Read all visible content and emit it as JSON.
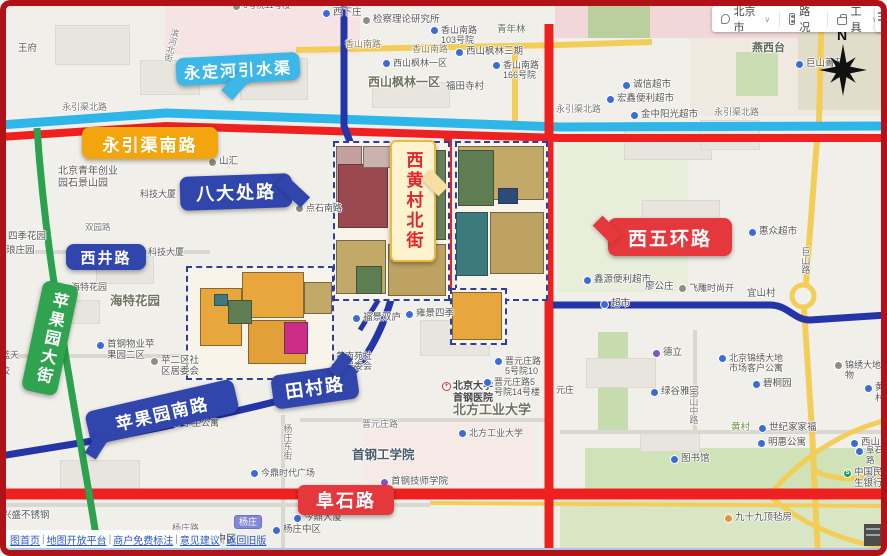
{
  "toolbar": {
    "city": "北京市",
    "traffic": "路况",
    "tools": "工具",
    "chevron": "∨"
  },
  "compass_label": "N",
  "callouts": {
    "yongdinghe": {
      "label": "永定河引水渠",
      "color": "#3db7e8",
      "text_color": "#ffffff"
    },
    "yongyinqu": {
      "label": "永引渠南路",
      "color": "#f2a50c",
      "text_color": "#ffffff"
    },
    "badachu": {
      "label": "八大处路",
      "color": "#3146ad",
      "text_color": "#ffffff"
    },
    "xijing": {
      "label": "西井路",
      "color": "#3146ad",
      "text_color": "#ffffff"
    },
    "pingguoyuan_dajie": {
      "label": "苹果园大街",
      "color": "#2fa350",
      "text_color": "#ffffff"
    },
    "pingguoyuan_nanlu": {
      "label": "苹果园南路",
      "color": "#3146ad",
      "text_color": "#ffffff"
    },
    "tiancun": {
      "label": "田村路",
      "color": "#3146ad",
      "text_color": "#ffffff"
    },
    "xihuangcun": {
      "label": "西黄村北街",
      "color": "#fdf4cf",
      "text_color": "#e2262b",
      "border_color": "#f0b840",
      "tail_color": "#f6dfa0"
    },
    "xiwuhuan": {
      "label": "西五环路",
      "color": "#e5383d",
      "text_color": "#ffffff"
    },
    "fushi": {
      "label": "阜石路",
      "color": "#e5383d",
      "text_color": "#ffffff"
    }
  },
  "road_colors": {
    "river": "#2eb6e8",
    "highlight_red": "#ee2020",
    "highlight_blue": "#2435a8",
    "highlight_green": "#2ca14e",
    "yellow": "#f2ce58",
    "minor": "#d9d7cf"
  },
  "footer": {
    "links": [
      "图首页",
      "地图开放平台",
      "商户免费标注",
      "意见建议",
      "返回旧版"
    ],
    "separator": "|"
  },
  "map_labels": [
    {
      "t": "6号院11号楼",
      "x": 232,
      "y": 1,
      "s": 8.5,
      "icon": "dot"
    },
    {
      "t": "王府",
      "x": 18,
      "y": 44
    },
    {
      "t": "滨河北街",
      "x": 166,
      "y": 28,
      "s": 8.5,
      "v": 1,
      "rot": 14,
      "c": "#777777"
    },
    {
      "t": "西下庄",
      "x": 322,
      "y": 8,
      "icon": "blue"
    },
    {
      "t": "检察理论研究所",
      "x": 362,
      "y": 15,
      "icon": "dot"
    },
    {
      "t": "香山南路",
      "x": 345,
      "y": 39,
      "s": 9,
      "c": "#8a7d55"
    },
    {
      "t": "香山南路",
      "x": 412,
      "y": 44,
      "s": 9,
      "c": "#8a7d55"
    },
    {
      "t": "香山南路\n103号院",
      "x": 430,
      "y": 25,
      "s": 9,
      "icon": "blue"
    },
    {
      "t": "青年林",
      "x": 497,
      "y": 25,
      "c": "#5c6e54"
    },
    {
      "t": "西山枫林三期",
      "x": 455,
      "y": 47,
      "icon": "blue"
    },
    {
      "t": "西山枫林一区",
      "x": 382,
      "y": 58,
      "s": 9,
      "icon": "blue"
    },
    {
      "t": "西山枫林一区",
      "x": 368,
      "y": 76,
      "s": 12,
      "b": 1,
      "c": "#6f735f"
    },
    {
      "t": "香山南路\n166号院",
      "x": 492,
      "y": 60,
      "s": 9,
      "icon": "blue"
    },
    {
      "t": "福田寺村",
      "x": 446,
      "y": 82
    },
    {
      "t": "燕西台",
      "x": 752,
      "y": 42,
      "s": 11,
      "b": 1,
      "c": "#5f6658"
    },
    {
      "t": "巨山菁苑",
      "x": 795,
      "y": 59,
      "icon": "blue"
    },
    {
      "t": "山路",
      "x": 818,
      "y": 4,
      "s": 9,
      "v": 1,
      "c": "#8a7d55"
    },
    {
      "t": "诚信超市",
      "x": 622,
      "y": 80,
      "icon": "blue"
    },
    {
      "t": "宏鑫便利超市",
      "x": 606,
      "y": 94,
      "icon": "blue"
    },
    {
      "t": "金中阳光超市",
      "x": 630,
      "y": 110,
      "icon": "blue"
    },
    {
      "t": "永引渠北路",
      "x": 62,
      "y": 102,
      "s": 9,
      "c": "#777777"
    },
    {
      "t": "永引渠北路",
      "x": 556,
      "y": 104,
      "s": 9,
      "c": "#777777"
    },
    {
      "t": "永引渠北路",
      "x": 714,
      "y": 107,
      "s": 9,
      "c": "#777777"
    },
    {
      "t": "北京青年创业\n园石景山园",
      "x": 58,
      "y": 166,
      "s": 10,
      "c": "#555555"
    },
    {
      "t": "山汇",
      "x": 208,
      "y": 157,
      "icon": "dot"
    },
    {
      "t": "科技大厦",
      "x": 140,
      "y": 189,
      "s": 9
    },
    {
      "t": "点石南路",
      "x": 295,
      "y": 203,
      "s": 9,
      "icon": "dot"
    },
    {
      "t": "四季花园",
      "x": 8,
      "y": 232
    },
    {
      "t": "琅庄园",
      "x": 6,
      "y": 246
    },
    {
      "t": "双园路",
      "x": 85,
      "y": 223,
      "s": 8.5,
      "c": "#777777"
    },
    {
      "t": "科技大厦",
      "x": 148,
      "y": 247,
      "s": 9
    },
    {
      "t": "海特花园",
      "x": 60,
      "y": 282,
      "s": 9,
      "icon": "blue"
    },
    {
      "t": "海特花园",
      "x": 110,
      "y": 294,
      "s": 12.5,
      "b": 1,
      "c": "#6f735f"
    },
    {
      "t": "蓝天",
      "x": 1,
      "y": 350,
      "s": 9
    },
    {
      "t": "校",
      "x": 1,
      "y": 366,
      "s": 9
    },
    {
      "t": "首钢物业苹\n果园二区",
      "x": 96,
      "y": 340,
      "icon": "blue"
    },
    {
      "t": "苹二区社\n区居委会",
      "x": 150,
      "y": 356,
      "icon": "dot"
    },
    {
      "t": "学生公寓",
      "x": 172,
      "y": 418,
      "s": 9,
      "icon": "blue"
    },
    {
      "t": "福景双庐",
      "x": 352,
      "y": 313,
      "icon": "blue"
    },
    {
      "t": "雍景四季",
      "x": 405,
      "y": 309,
      "icon": "blue"
    },
    {
      "t": "黄南苑社\n区居委会",
      "x": 336,
      "y": 351,
      "s": 9
    },
    {
      "t": "北京大学\n首钢医院",
      "x": 442,
      "y": 381,
      "s": 10,
      "b": 1,
      "c": "#444444",
      "icon": "hospital"
    },
    {
      "t": "晋元庄路\n5号院10",
      "x": 494,
      "y": 356,
      "s": 9,
      "icon": "blue"
    },
    {
      "t": "晋元庄路5\n号院14号楼",
      "x": 483,
      "y": 377,
      "s": 9,
      "icon": "blue"
    },
    {
      "t": "元庄",
      "x": 556,
      "y": 385,
      "s": 9
    },
    {
      "t": "晋元庄路",
      "x": 362,
      "y": 419,
      "s": 9,
      "c": "#777777"
    },
    {
      "t": "北方工业大学",
      "x": 453,
      "y": 403,
      "s": 13,
      "b": 1,
      "c": "#6f735f"
    },
    {
      "t": "北方工业大学",
      "x": 458,
      "y": 428,
      "s": 9,
      "icon": "blue"
    },
    {
      "t": "首钢工学院",
      "x": 352,
      "y": 448,
      "s": 12.5,
      "b": 1,
      "c": "#4d5c6a"
    },
    {
      "t": "首钢技师学院",
      "x": 380,
      "y": 477,
      "icon": "purple"
    },
    {
      "t": "图书馆",
      "x": 670,
      "y": 454,
      "icon": "blue"
    },
    {
      "t": "杨庄东街",
      "x": 282,
      "y": 424,
      "s": 9,
      "v": 1,
      "c": "#777777"
    },
    {
      "t": "今鼎时代广场",
      "x": 250,
      "y": 468,
      "s": 9,
      "icon": "blue"
    },
    {
      "t": "今鼎大厦",
      "x": 293,
      "y": 513,
      "icon": "blue"
    },
    {
      "t": "杨庄中区",
      "x": 272,
      "y": 525,
      "icon": "blue"
    },
    {
      "t": "兴盛不锈钢",
      "x": 2,
      "y": 511
    },
    {
      "t": "杨庄路",
      "x": 172,
      "y": 523,
      "s": 9,
      "c": "#777777"
    },
    {
      "t": "中区",
      "x": 216,
      "y": 534,
      "s": 10,
      "c": "#444444"
    },
    {
      "t": "杨庄",
      "x": 234,
      "y": 515,
      "badge": 1
    },
    {
      "t": "德立",
      "x": 652,
      "y": 348,
      "icon": "purple"
    },
    {
      "t": "北京锦绣大地\n市场客户公寓",
      "x": 718,
      "y": 353,
      "s": 9,
      "icon": "blue"
    },
    {
      "t": "碧桐园",
      "x": 752,
      "y": 379,
      "icon": "blue"
    },
    {
      "t": "绿谷雅园",
      "x": 650,
      "y": 387,
      "icon": "blue"
    },
    {
      "t": "宝山中路",
      "x": 688,
      "y": 388,
      "s": 9,
      "v": 1,
      "c": "#777777"
    },
    {
      "t": "黄村",
      "x": 731,
      "y": 423,
      "c": "#6d8f3f"
    },
    {
      "t": "世纪家家福",
      "x": 758,
      "y": 423,
      "icon": "blue"
    },
    {
      "t": "明惠公寓",
      "x": 757,
      "y": 438,
      "icon": "blue"
    },
    {
      "t": "惠众超市",
      "x": 748,
      "y": 227,
      "icon": "blue"
    },
    {
      "t": "鑫源便利超市",
      "x": 583,
      "y": 275,
      "icon": "blue"
    },
    {
      "t": "廖公庄",
      "x": 645,
      "y": 282
    },
    {
      "t": "飞雕时尚开",
      "x": 678,
      "y": 283,
      "s": 9,
      "icon": "dot"
    },
    {
      "t": "宜山村",
      "x": 747,
      "y": 289
    },
    {
      "t": "超市",
      "x": 600,
      "y": 299,
      "icon": "blue"
    },
    {
      "t": "巨山路",
      "x": 800,
      "y": 247,
      "s": 9,
      "v": 1,
      "c": "#666666"
    },
    {
      "t": "锦绣大地物",
      "x": 834,
      "y": 360,
      "s": 9,
      "icon": "dot"
    },
    {
      "t": "黄村",
      "x": 864,
      "y": 383,
      "icon": "blue"
    },
    {
      "t": "西山",
      "x": 850,
      "y": 438,
      "icon": "blue"
    },
    {
      "t": "阜石路\n9号院",
      "x": 855,
      "y": 446,
      "s": 8.5,
      "icon": "blue"
    },
    {
      "t": "中国民生银行",
      "x": 843,
      "y": 468,
      "icon": "bank"
    },
    {
      "t": "九十九顶毡房",
      "x": 724,
      "y": 513,
      "icon": "orange"
    }
  ],
  "zones": [
    [
      165,
      0,
      195,
      55,
      "#f6e3e3"
    ],
    [
      555,
      0,
      332,
      38,
      "#f1d7d7"
    ],
    [
      588,
      0,
      62,
      38,
      "#bacf9d"
    ],
    [
      690,
      38,
      197,
      78,
      "#efe9df"
    ],
    [
      736,
      52,
      42,
      44,
      "#cadcb1"
    ],
    [
      798,
      30,
      89,
      80,
      "#e0ddca"
    ],
    [
      558,
      142,
      130,
      150,
      "#e9eedb"
    ],
    [
      598,
      332,
      30,
      98,
      "#c7dcae"
    ],
    [
      585,
      448,
      302,
      42,
      "#cfe2b8"
    ],
    [
      560,
      500,
      327,
      56,
      "#d9e6c6"
    ],
    [
      363,
      424,
      172,
      58,
      "#f5eae6"
    ]
  ],
  "buildings": [
    [
      55,
      25,
      75,
      40
    ],
    [
      140,
      60,
      60,
      35
    ],
    [
      240,
      58,
      68,
      42
    ],
    [
      372,
      82,
      78,
      26
    ],
    [
      96,
      256,
      58,
      28
    ],
    [
      624,
      122,
      88,
      38
    ],
    [
      642,
      200,
      78,
      38
    ],
    [
      700,
      120,
      60,
      30
    ],
    [
      60,
      300,
      40,
      24
    ],
    [
      420,
      320,
      70,
      36
    ],
    [
      586,
      358,
      70,
      30
    ],
    [
      640,
      430,
      60,
      22
    ],
    [
      60,
      460,
      80,
      30
    ]
  ],
  "parcel_groups": [
    {
      "bbox": [
        333,
        141,
        117,
        160
      ],
      "blocks": [
        [
          336,
          146,
          26,
          56,
          "#c59fa0"
        ],
        [
          338,
          164,
          50,
          64,
          "#9a4a4f"
        ],
        [
          363,
          146,
          38,
          22,
          "#cbb2ac"
        ],
        [
          390,
          150,
          56,
          90,
          "#64805a"
        ],
        [
          336,
          240,
          50,
          54,
          "#c3a968"
        ],
        [
          388,
          244,
          58,
          52,
          "#bda261"
        ],
        [
          356,
          266,
          26,
          28,
          "#5f7d52"
        ]
      ]
    },
    {
      "bbox": [
        455,
        141,
        93,
        160
      ],
      "blocks": [
        [
          458,
          146,
          86,
          54,
          "#c3a968"
        ],
        [
          458,
          150,
          36,
          56,
          "#5f7d52"
        ],
        [
          498,
          188,
          20,
          16,
          "#2e4a7a"
        ],
        [
          456,
          212,
          32,
          64,
          "#3d7a7e"
        ],
        [
          490,
          212,
          54,
          62,
          "#bda261"
        ]
      ]
    },
    {
      "bbox": [
        186,
        266,
        148,
        114
      ],
      "blocks": [
        [
          200,
          288,
          42,
          58,
          "#e8a73d"
        ],
        [
          242,
          272,
          62,
          46,
          "#e8a73d"
        ],
        [
          248,
          320,
          58,
          44,
          "#e2a138"
        ],
        [
          284,
          322,
          24,
          32,
          "#ce2d87"
        ],
        [
          228,
          300,
          24,
          24,
          "#5f7d52"
        ],
        [
          214,
          294,
          14,
          12,
          "#3d7a7e"
        ],
        [
          304,
          282,
          28,
          32,
          "#c3a968"
        ]
      ]
    },
    {
      "bbox": [
        450,
        288,
        57,
        57
      ],
      "blocks": [
        [
          452,
          292,
          50,
          48,
          "#e8a73d"
        ]
      ]
    }
  ]
}
